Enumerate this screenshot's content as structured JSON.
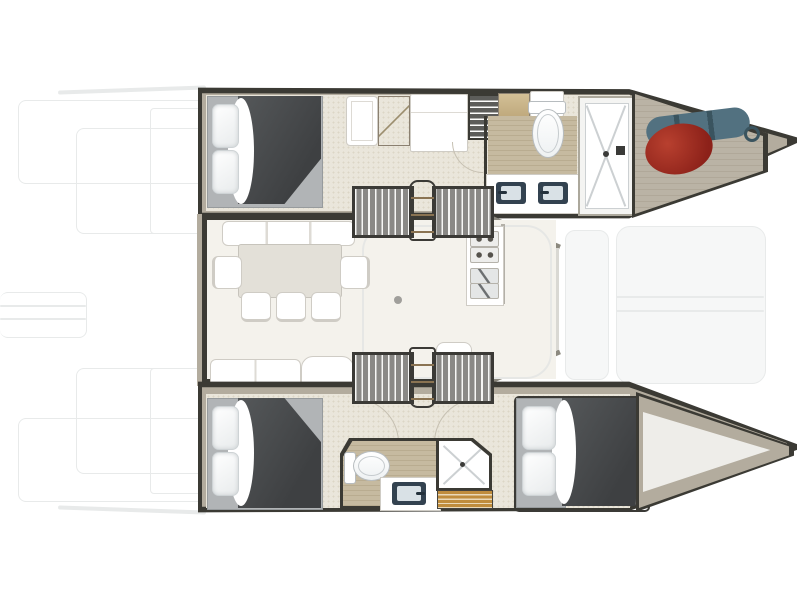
{
  "diagram": {
    "type": "floor-plan",
    "subject": "catamaran yacht interior layout, top-down view, bow pointing right",
    "areas": {
      "port_hull": {
        "position": "top",
        "rooms": [
          {
            "name": "aft-double-cabin",
            "items": [
              "double-bed",
              "two-pillows",
              "dark-duvet"
            ]
          },
          {
            "name": "passage",
            "items": [
              "wardrobe",
              "wood-cabinet",
              "fridge-cabinet",
              "shelf-unit"
            ]
          },
          {
            "name": "bathroom",
            "items": [
              "toilet",
              "twin-sink-vanity",
              "shower-with-drain"
            ]
          },
          {
            "name": "bow-locker",
            "items": [
              "red-fender",
              "blue-gear-bag"
            ]
          }
        ]
      },
      "salon": {
        "position": "center",
        "items": [
          "forward-sofa",
          "dining-table",
          "two-end-chairs",
          "three-chairs",
          "aft-bench",
          "corner-seat",
          "nav-seat",
          "galley-counter-stove-sink",
          "port-companionway-stairs",
          "starboard-companionway-stairs",
          "door-handle-dot"
        ]
      },
      "starboard_hull": {
        "position": "bottom",
        "rooms": [
          {
            "name": "aft-double-cabin",
            "items": [
              "double-bed",
              "two-pillows",
              "dark-duvet"
            ]
          },
          {
            "name": "central-bathroom",
            "items": [
              "toilet",
              "sink-vanity",
              "shower-with-drain",
              "teak-slat-bench"
            ]
          },
          {
            "name": "forward-double-cabin",
            "items": [
              "double-bed",
              "two-pillows",
              "dark-duvet"
            ]
          },
          {
            "name": "bow-wedge",
            "items": []
          }
        ]
      },
      "deck_outlines_faint": [
        "aft-cockpit",
        "stern-platform",
        "foredeck-trampoline"
      ]
    }
  },
  "colors": {
    "wall": "#3b3a34",
    "rim": "#b3ac9e",
    "cabin_floor": "#eae6db",
    "speck": "#dcd6c6",
    "salon_floor": "#f4f2ec",
    "bath_floor": "#c6baa0",
    "bath_stripe": "#b9ac90",
    "bed_base": "#b1b4b6",
    "duvet_light": "#55585a",
    "duvet_dark": "#3e4042",
    "pillow_light": "#ffffff",
    "pillow_shade": "#e8ebec",
    "pillow_border": "#ced3d5",
    "furniture_white": "#ffffff",
    "furniture_border": "#cfccc5",
    "table": "#e3e0d8",
    "stairs_bg": "#8a8986",
    "stairs_hatch": "#f7f7f5",
    "stairs_frame": "#3b3a36",
    "grid_cabinet": "#5d5d5a",
    "wood_light": "#d8c59b",
    "wood_dark": "#ae9569",
    "wood_line": "#8a7352",
    "sink_dark": "#334250",
    "basin": "#d9e1e6",
    "toilet_border": "#b7bcbf",
    "teak": "#bf8c3c",
    "teak_gap": "#ead9b8",
    "fender_light": "#b8402f",
    "fender_dark": "#8c2119",
    "gear_light": "#527180",
    "gear_dark": "#3a545f",
    "storage_floor": "#b7b0a2",
    "faint": "#e8eaea",
    "tramp_fill": "#f6f7f7",
    "shower_line": "#ccd0d2",
    "shower_border": "#aca89c",
    "backsplash": "#b3b0a8",
    "arc_line": "#c6c0b2",
    "slant_wall": "#8c897f",
    "door_line": "#d9d8d3",
    "dot": "#a09f9b",
    "wedge_inner": "#eeede9"
  }
}
